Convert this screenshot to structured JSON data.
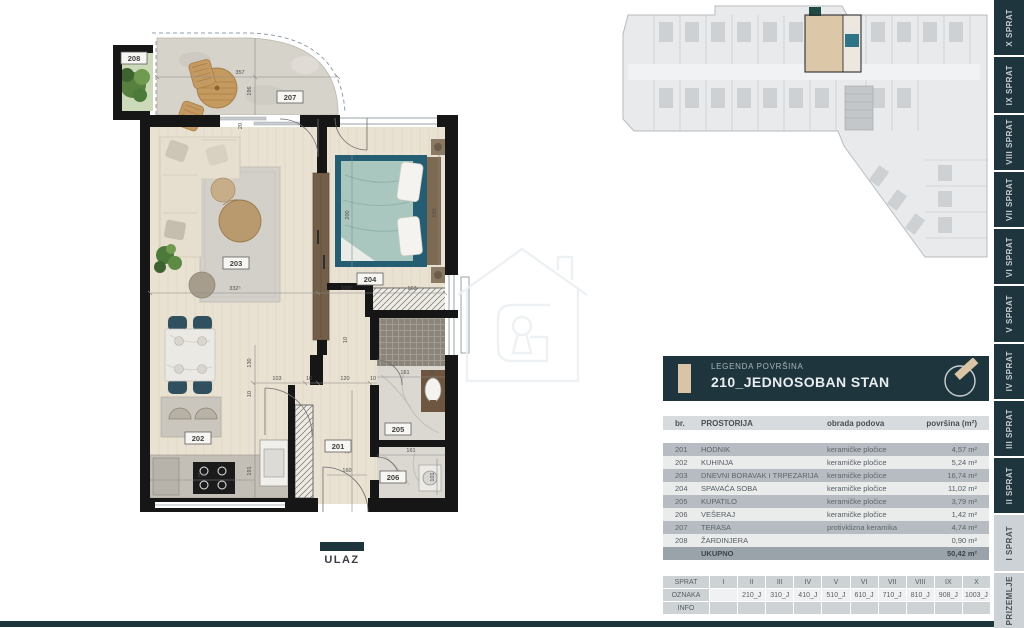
{
  "floor_plan": {
    "entrance_label": "ULAZ",
    "rooms": {
      "hodnik": "201",
      "kuhinja": "202",
      "dnevni": "203",
      "spavaca": "204",
      "kupatilo": "205",
      "veseraj": "206",
      "terasa": "207",
      "zardinjera": "208"
    },
    "dims": {
      "terrace_w": "357",
      "terrace_h": "196",
      "wall20": "20",
      "living_w": "332⁵",
      "hall_top_w": "101⁵",
      "wardrobe_w": "163",
      "opening": "103",
      "ten_a": "10",
      "corridor_w": "120",
      "ten_b": "10",
      "dining_h": "130",
      "ten_c": "10",
      "kitchen_h": "191",
      "corridor_h": "350",
      "kitchen_w": "274",
      "hall_w": "160",
      "bath_w": "161",
      "bath_w2": "25",
      "veseraj_w": "161",
      "veseraj_h": "101",
      "bed_l": "200",
      "bed_r": "190",
      "ten_d": "10"
    }
  },
  "legend": {
    "subtitle": "LEGENDA POVRŠINA",
    "title": "210_JEDNOSOBAN STAN",
    "columns": {
      "br": "br.",
      "name": "PROSTORIJA",
      "floor": "obrada podova",
      "area": "površina (m²)"
    },
    "rows": [
      {
        "br": "201",
        "name": "HODNIK",
        "floor": "keramičke pločice",
        "area": "4,57 m²"
      },
      {
        "br": "202",
        "name": "KUHINJA",
        "floor": "keramičke pločice",
        "area": "5,24 m²"
      },
      {
        "br": "203",
        "name": "DNEVNI BORAVAK I TRPEZARIJA",
        "floor": "keramičke pločice",
        "area": "16,74 m²"
      },
      {
        "br": "204",
        "name": "SPAVAĆA SOBA",
        "floor": "keramičke pločice",
        "area": "11,02 m²"
      },
      {
        "br": "205",
        "name": "KUPATILO",
        "floor": "keramičke pločice",
        "area": "3,79 m²"
      },
      {
        "br": "206",
        "name": "VEŠERAJ",
        "floor": "keramičke pločice",
        "area": "1,42 m²"
      },
      {
        "br": "207",
        "name": "TERASA",
        "floor": "protivklizna keramika",
        "area": "4,74 m²"
      },
      {
        "br": "208",
        "name": "ŽARDINJERA",
        "floor": "",
        "area": "0,90 m²"
      }
    ],
    "total_label": "UKUPNO",
    "total_area": "50,42 m²"
  },
  "floors_table": {
    "sprat_label": "SPRAT",
    "oznaka_label": "OZNAKA",
    "info_label": "INFO",
    "columns": [
      "I",
      "II",
      "III",
      "IV",
      "V",
      "VI",
      "VII",
      "VIII",
      "IX",
      "X"
    ],
    "oznaka": [
      "",
      "210_J",
      "310_J",
      "410_J",
      "510_J",
      "610_J",
      "710_J",
      "810_J",
      "908_J",
      "1003_J"
    ]
  },
  "sidebar": {
    "items": [
      {
        "label": "X SPRAT",
        "style": "dark"
      },
      {
        "label": "IX SPRAT",
        "style": "dark"
      },
      {
        "label": "VIII SPRAT",
        "style": "dark"
      },
      {
        "label": "VII SPRAT",
        "style": "dark"
      },
      {
        "label": "VI SPRAT",
        "style": "dark"
      },
      {
        "label": "V SPRAT",
        "style": "dark"
      },
      {
        "label": "IV SPRAT",
        "style": "dark"
      },
      {
        "label": "III SPRAT",
        "style": "dark"
      },
      {
        "label": "II SPRAT",
        "style": "dark"
      },
      {
        "label": "I SPRAT",
        "style": "light"
      },
      {
        "label": "PRIZEMLJE",
        "style": "light"
      }
    ]
  },
  "colors": {
    "accent_dark": "#1e353d",
    "accent_beige": "#d9c4a6",
    "bed_teal": "#2e7386"
  }
}
